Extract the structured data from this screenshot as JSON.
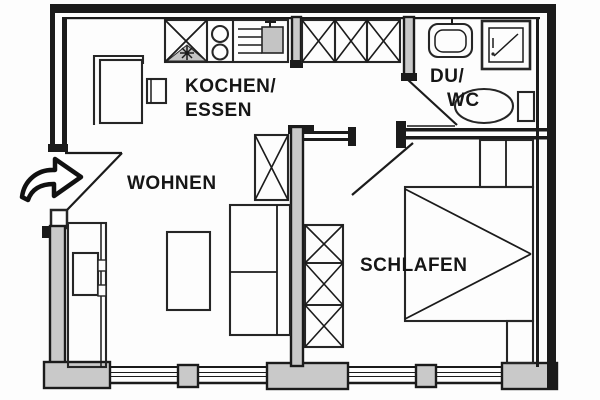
{
  "meta": {
    "type": "apartment-floor-plan",
    "language": "de"
  },
  "rooms": {
    "kitchen_dining": {
      "label_line1": "KOCHEN/",
      "label_line2": "ESSEN"
    },
    "living": {
      "label": "WOHNEN"
    },
    "shower_wc": {
      "label_line1": "DU/",
      "label_line2": "WC"
    },
    "bedroom": {
      "label": "SCHLAFEN"
    }
  },
  "symbols": {
    "entrance_arrow": "curved-arrow-pointing-right-at-entrance-door",
    "kitchen_counter": [
      "crossed-sink-unit-with-star",
      "cooktop-two-burners",
      "worktop-with-shaded-sink"
    ],
    "hall_closet": "wardrobe-three-crossed-sections",
    "bedroom_wardrobe": "wardrobe-three-crossed-sections",
    "bed": "double-diagonal-bed-symbol",
    "bath_fixtures": [
      "washbasin",
      "shower-tray",
      "toilet-with-cistern"
    ],
    "windows": "multi-line-window-bands-with-mullions",
    "doors": [
      "entrance-door-swing",
      "bedroom-door-swing",
      "bathroom-door-swing"
    ]
  },
  "colors": {
    "line": "#1b1b1b",
    "wall_fill": "#c9c9c9",
    "paper": "#fdfdfd",
    "text": "#161616"
  }
}
